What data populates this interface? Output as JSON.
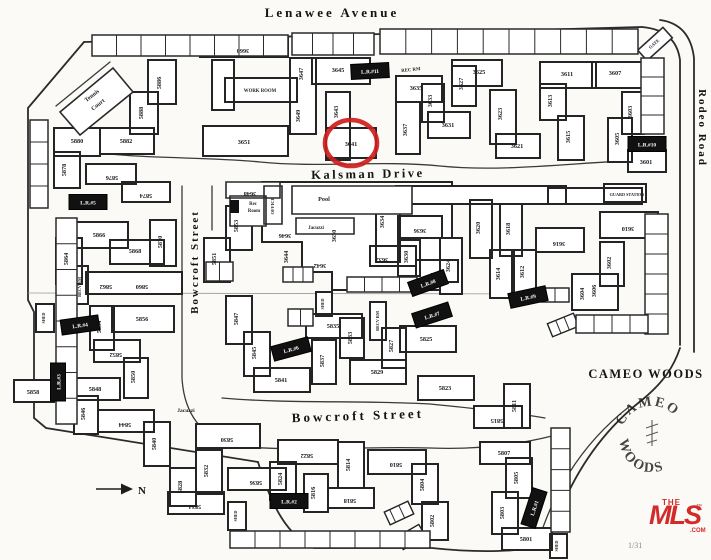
{
  "map": {
    "streets": [
      {
        "name": "Lenawee Avenue",
        "x": 332,
        "y": 17,
        "rotate": 0,
        "size": 13,
        "ls": 3
      },
      {
        "name": "Kalsman Drive",
        "x": 368,
        "y": 178,
        "rotate": -1,
        "size": 12.5,
        "ls": 2.5
      },
      {
        "name": "Bowcroft Street",
        "x": 198,
        "y": 262,
        "rotate": -90,
        "size": 11,
        "ls": 2
      },
      {
        "name": "Bowcroft Street",
        "x": 358,
        "y": 420,
        "rotate": -2,
        "size": 13,
        "ls": 3
      },
      {
        "name": "Rodeo Road",
        "x": 699,
        "y": 128,
        "rotate": 90,
        "size": 11,
        "ls": 2
      }
    ],
    "units": [
      {
        "n": "3660",
        "x": 243,
        "y": 49,
        "r": 180
      },
      {
        "n": "3647",
        "x": 303,
        "y": 74,
        "r": -90
      },
      {
        "n": "3645",
        "x": 338,
        "y": 72,
        "r": 0
      },
      {
        "n": "3649",
        "x": 300,
        "y": 116,
        "r": -90
      },
      {
        "n": "3643",
        "x": 338,
        "y": 112,
        "r": -90
      },
      {
        "n": "3651",
        "x": 244,
        "y": 144,
        "r": 0
      },
      {
        "n": "3641",
        "x": 351,
        "y": 146,
        "r": 0
      },
      {
        "n": "3635",
        "x": 416,
        "y": 90,
        "r": 0
      },
      {
        "n": "3633",
        "x": 432,
        "y": 101,
        "r": -90
      },
      {
        "n": "3637",
        "x": 407,
        "y": 130,
        "r": -90
      },
      {
        "n": "3631",
        "x": 448,
        "y": 127,
        "r": 0
      },
      {
        "n": "3627",
        "x": 463,
        "y": 84,
        "r": -90
      },
      {
        "n": "3625",
        "x": 479,
        "y": 74,
        "r": 0
      },
      {
        "n": "3623",
        "x": 502,
        "y": 114,
        "r": -90
      },
      {
        "n": "3621",
        "x": 517,
        "y": 148,
        "r": 0
      },
      {
        "n": "3611",
        "x": 567,
        "y": 76,
        "r": 0
      },
      {
        "n": "3613",
        "x": 552,
        "y": 101,
        "r": -90
      },
      {
        "n": "3607",
        "x": 615,
        "y": 75,
        "r": 0
      },
      {
        "n": "3615",
        "x": 570,
        "y": 137,
        "r": -90
      },
      {
        "n": "3605",
        "x": 619,
        "y": 139,
        "r": -90
      },
      {
        "n": "3603",
        "x": 632,
        "y": 112,
        "r": -90
      },
      {
        "n": "3601",
        "x": 646,
        "y": 164,
        "r": 0
      },
      {
        "n": "3648",
        "x": 250,
        "y": 192,
        "r": 180
      },
      {
        "n": "3646",
        "x": 285,
        "y": 234,
        "r": 180
      },
      {
        "n": "3644",
        "x": 288,
        "y": 257,
        "r": -90
      },
      {
        "n": "3642",
        "x": 320,
        "y": 264,
        "r": 180
      },
      {
        "n": "3650",
        "x": 336,
        "y": 236,
        "r": -90
      },
      {
        "n": "3634",
        "x": 384,
        "y": 222,
        "r": -90
      },
      {
        "n": "3636",
        "x": 420,
        "y": 229,
        "r": 180
      },
      {
        "n": "3632",
        "x": 382,
        "y": 258,
        "r": 180
      },
      {
        "n": "3630",
        "x": 408,
        "y": 257,
        "r": -90
      },
      {
        "n": "3620",
        "x": 480,
        "y": 228,
        "r": -90
      },
      {
        "n": "3618",
        "x": 510,
        "y": 229,
        "r": -90
      },
      {
        "n": "3616",
        "x": 559,
        "y": 242,
        "r": 180
      },
      {
        "n": "3624",
        "x": 450,
        "y": 266,
        "r": -90
      },
      {
        "n": "3622",
        "x": 437,
        "y": 273,
        "r": 180
      },
      {
        "n": "3614",
        "x": 500,
        "y": 274,
        "r": -90
      },
      {
        "n": "3612",
        "x": 524,
        "y": 272,
        "r": -90
      },
      {
        "n": "3610",
        "x": 628,
        "y": 227,
        "r": 180
      },
      {
        "n": "3602",
        "x": 611,
        "y": 263,
        "r": -90
      },
      {
        "n": "3604",
        "x": 584,
        "y": 294,
        "r": -90
      },
      {
        "n": "3606",
        "x": 596,
        "y": 291,
        "r": -90
      },
      {
        "n": "5886",
        "x": 161,
        "y": 83,
        "r": -90
      },
      {
        "n": "5888",
        "x": 143,
        "y": 113,
        "r": -90
      },
      {
        "n": "5882",
        "x": 126,
        "y": 143,
        "r": 0
      },
      {
        "n": "5880",
        "x": 77,
        "y": 143,
        "r": 0
      },
      {
        "n": "5878",
        "x": 66,
        "y": 170,
        "r": -90
      },
      {
        "n": "5876",
        "x": 112,
        "y": 176,
        "r": 180
      },
      {
        "n": "5874",
        "x": 146,
        "y": 194,
        "r": 180
      },
      {
        "n": "5866",
        "x": 99,
        "y": 237,
        "r": 0
      },
      {
        "n": "5864",
        "x": 68,
        "y": 259,
        "r": -90
      },
      {
        "n": "5868",
        "x": 135,
        "y": 253,
        "r": 0
      },
      {
        "n": "5870",
        "x": 162,
        "y": 242,
        "r": -90
      },
      {
        "n": "5862",
        "x": 106,
        "y": 285,
        "r": 180
      },
      {
        "n": "5860",
        "x": 142,
        "y": 285,
        "r": 180
      },
      {
        "n": "5853",
        "x": 238,
        "y": 226,
        "r": -90
      },
      {
        "n": "5851",
        "x": 216,
        "y": 259,
        "r": -90
      },
      {
        "n": "5856",
        "x": 142,
        "y": 321,
        "r": 0
      },
      {
        "n": "5854",
        "x": 101,
        "y": 327,
        "r": -90
      },
      {
        "n": "5852",
        "x": 116,
        "y": 353,
        "r": 180
      },
      {
        "n": "5850",
        "x": 135,
        "y": 377,
        "r": -90
      },
      {
        "n": "5858",
        "x": 33,
        "y": 394,
        "r": 0
      },
      {
        "n": "5848",
        "x": 95,
        "y": 391,
        "r": 0
      },
      {
        "n": "5846",
        "x": 85,
        "y": 414,
        "r": -90
      },
      {
        "n": "5844",
        "x": 125,
        "y": 423,
        "r": 180
      },
      {
        "n": "5847",
        "x": 238,
        "y": 319,
        "r": -90
      },
      {
        "n": "5845",
        "x": 256,
        "y": 353,
        "r": -90
      },
      {
        "n": "5841",
        "x": 281,
        "y": 382,
        "r": 0
      },
      {
        "n": "5835",
        "x": 333,
        "y": 328,
        "r": 0
      },
      {
        "n": "5833",
        "x": 352,
        "y": 338,
        "r": -90
      },
      {
        "n": "5837",
        "x": 324,
        "y": 361,
        "r": -90
      },
      {
        "n": "5829",
        "x": 377,
        "y": 374,
        "r": 0
      },
      {
        "n": "5827",
        "x": 393,
        "y": 346,
        "r": -90
      },
      {
        "n": "5825",
        "x": 426,
        "y": 341,
        "r": 0
      },
      {
        "n": "5823",
        "x": 445,
        "y": 390,
        "r": 0
      },
      {
        "n": "5840",
        "x": 156,
        "y": 444,
        "r": -90
      },
      {
        "n": "5830",
        "x": 227,
        "y": 438,
        "r": 180
      },
      {
        "n": "5832",
        "x": 208,
        "y": 471,
        "r": -90
      },
      {
        "n": "5828",
        "x": 182,
        "y": 487,
        "r": -90
      },
      {
        "n": "5834",
        "x": 195,
        "y": 505,
        "r": 180
      },
      {
        "n": "5836",
        "x": 256,
        "y": 481,
        "r": 180
      },
      {
        "n": "5822",
        "x": 307,
        "y": 454,
        "r": 180
      },
      {
        "n": "5824",
        "x": 282,
        "y": 479,
        "r": -90
      },
      {
        "n": "5814",
        "x": 350,
        "y": 465,
        "r": -90
      },
      {
        "n": "5816",
        "x": 315,
        "y": 493,
        "r": -90
      },
      {
        "n": "5818",
        "x": 350,
        "y": 499,
        "r": 180
      },
      {
        "n": "5810",
        "x": 396,
        "y": 463,
        "r": 180
      },
      {
        "n": "5804",
        "x": 424,
        "y": 485,
        "r": -90
      },
      {
        "n": "5802",
        "x": 434,
        "y": 521,
        "r": -90
      },
      {
        "n": "5811",
        "x": 516,
        "y": 406,
        "r": -90
      },
      {
        "n": "5815",
        "x": 497,
        "y": 419,
        "r": 180
      },
      {
        "n": "5807",
        "x": 504,
        "y": 455,
        "r": 0
      },
      {
        "n": "5805",
        "x": 518,
        "y": 478,
        "r": -90
      },
      {
        "n": "5803",
        "x": 504,
        "y": 513,
        "r": -90
      },
      {
        "n": "5801",
        "x": 526,
        "y": 541,
        "r": 0
      }
    ],
    "amenities": [
      {
        "t": "Tennis",
        "x": 93,
        "y": 97,
        "r": -38,
        "s": 6
      },
      {
        "t": "Court",
        "x": 99,
        "y": 106,
        "r": -38,
        "s": 6
      },
      {
        "t": "WORK ROOM",
        "x": 260,
        "y": 92,
        "r": 0,
        "s": 4.8
      },
      {
        "t": "REC RM",
        "x": 411,
        "y": 71,
        "r": -6,
        "s": 4.8
      },
      {
        "t": "Rec",
        "x": 253,
        "y": 205,
        "r": 0,
        "s": 4.8
      },
      {
        "t": "Room",
        "x": 254,
        "y": 212,
        "r": 0,
        "s": 4.8
      },
      {
        "t": "OFFICE",
        "x": 274,
        "y": 206,
        "r": -90,
        "s": 4.5
      },
      {
        "t": "Pool",
        "x": 324,
        "y": 201,
        "r": 0,
        "s": 6.2
      },
      {
        "t": "Jacuzzi",
        "x": 316,
        "y": 229,
        "r": 0,
        "s": 5
      },
      {
        "t": "GUARD STATION",
        "x": 627,
        "y": 196,
        "r": 0,
        "s": 4.2
      },
      {
        "t": "RECV RM",
        "x": 81,
        "y": 287,
        "r": -90,
        "s": 4.2
      },
      {
        "t": "RECV RM",
        "x": 379,
        "y": 321,
        "r": -90,
        "s": 4.2
      },
      {
        "t": "SHED",
        "x": 45,
        "y": 318,
        "r": -90,
        "s": 4
      },
      {
        "t": "SHED",
        "x": 324,
        "y": 304,
        "r": -90,
        "s": 4
      },
      {
        "t": "SHED",
        "x": 237,
        "y": 516,
        "r": -90,
        "s": 4
      },
      {
        "t": "SHED",
        "x": 558,
        "y": 546,
        "r": -90,
        "s": 4
      },
      {
        "t": "GATE",
        "x": 655,
        "y": 45,
        "r": -42,
        "s": 4.5
      },
      {
        "t": "Jacuzzi",
        "x": 186,
        "y": 412,
        "r": 0,
        "s": 5.5
      }
    ],
    "laundry": [
      {
        "label": "L.R.#11",
        "x": 370,
        "y": 71,
        "r": -3
      },
      {
        "label": "L.R.#10",
        "x": 647,
        "y": 144,
        "r": 0
      },
      {
        "label": "L.R.#9",
        "x": 528,
        "y": 297,
        "r": -12
      },
      {
        "label": "L.R.#8",
        "x": 428,
        "y": 283,
        "r": -20
      },
      {
        "label": "L.R.#7",
        "x": 432,
        "y": 315,
        "r": -18
      },
      {
        "label": "L.R.#6",
        "x": 291,
        "y": 349,
        "r": -15
      },
      {
        "label": "L.R.#5",
        "x": 88,
        "y": 202,
        "r": 0
      },
      {
        "label": "L.R.#4",
        "x": 80,
        "y": 325,
        "r": -8
      },
      {
        "label": "L.R.#3",
        "x": 58,
        "y": 382,
        "r": -90
      },
      {
        "label": "L.R.#2",
        "x": 289,
        "y": 501,
        "r": 0
      },
      {
        "label": "L.R.#1",
        "x": 534,
        "y": 508,
        "r": -72
      }
    ],
    "highlight": {
      "unit": "3641",
      "x": 351,
      "y": 143,
      "rx": 26,
      "ry": 23,
      "color": "#ce1d1d"
    },
    "compass": {
      "label": "N"
    },
    "area": {
      "label": "CAMEO WOODS"
    },
    "logo_circle": {
      "top": "CAMEO",
      "bottom": "WOODS"
    },
    "mls_logo": {
      "the": "THE",
      "mls": "MLS",
      "tm": "™",
      "com": ".COM",
      "color": "#d32b2b"
    },
    "page_note": "1/31"
  }
}
